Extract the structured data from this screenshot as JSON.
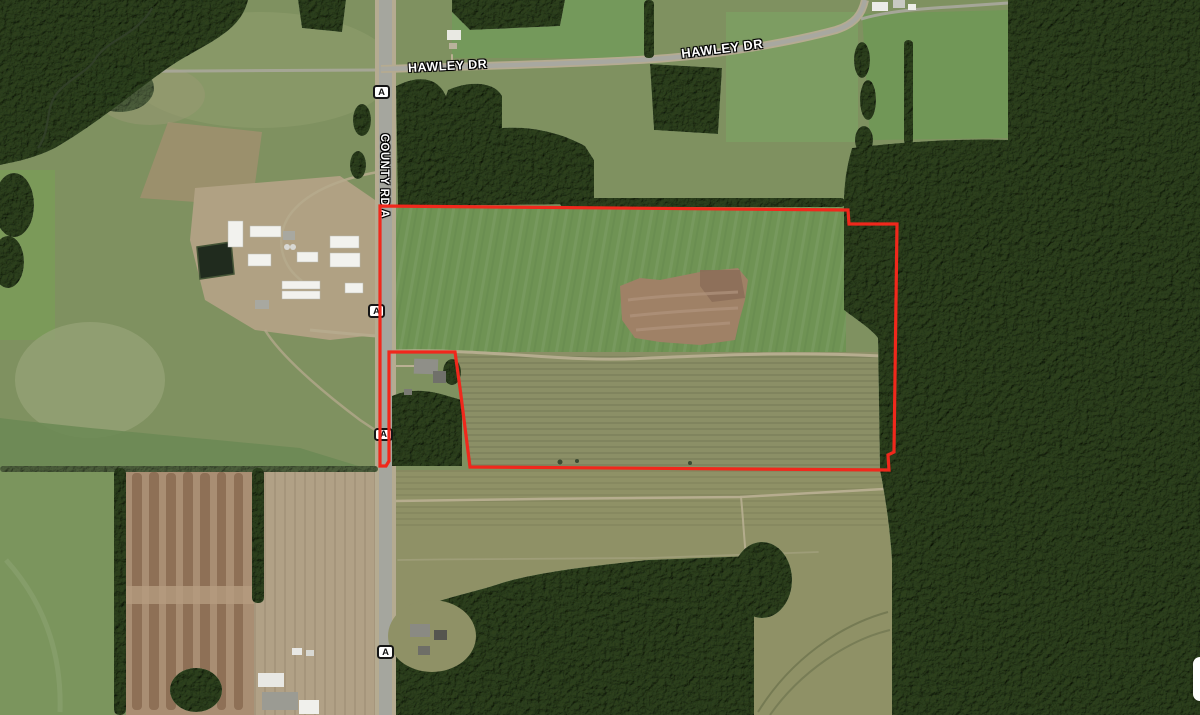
{
  "map_labels": {
    "county_road": "COUNTY RD A",
    "hawley_dr_west": "HAWLEY DR",
    "hawley_dr_east": "HAWLEY DR"
  },
  "route_shields": [
    {
      "label": "A"
    },
    {
      "label": "A"
    },
    {
      "label": "A"
    },
    {
      "label": "A"
    }
  ],
  "parcel": {
    "boundary_color": "#f0281c",
    "boundary_points": "381,206 848,210 849,224 897,224 894,452 888,455 889,470 470,467 460,388 455,352 389,352 389,461 386,466 380,466 380,206"
  },
  "palette": {
    "bright_field_green": "#6f9354",
    "pasture_green": "#7f9160",
    "harvested_olive": "#8b8f66",
    "forest_dark_green": "#55664a",
    "plowed_brown": "#a98e73",
    "bare_tan": "#b1a186",
    "road_gray": "#a8a8a0",
    "label_text": "#ffffff",
    "label_outline": "#000000",
    "shield_fill": "#ffffff",
    "shield_border": "#151515"
  }
}
